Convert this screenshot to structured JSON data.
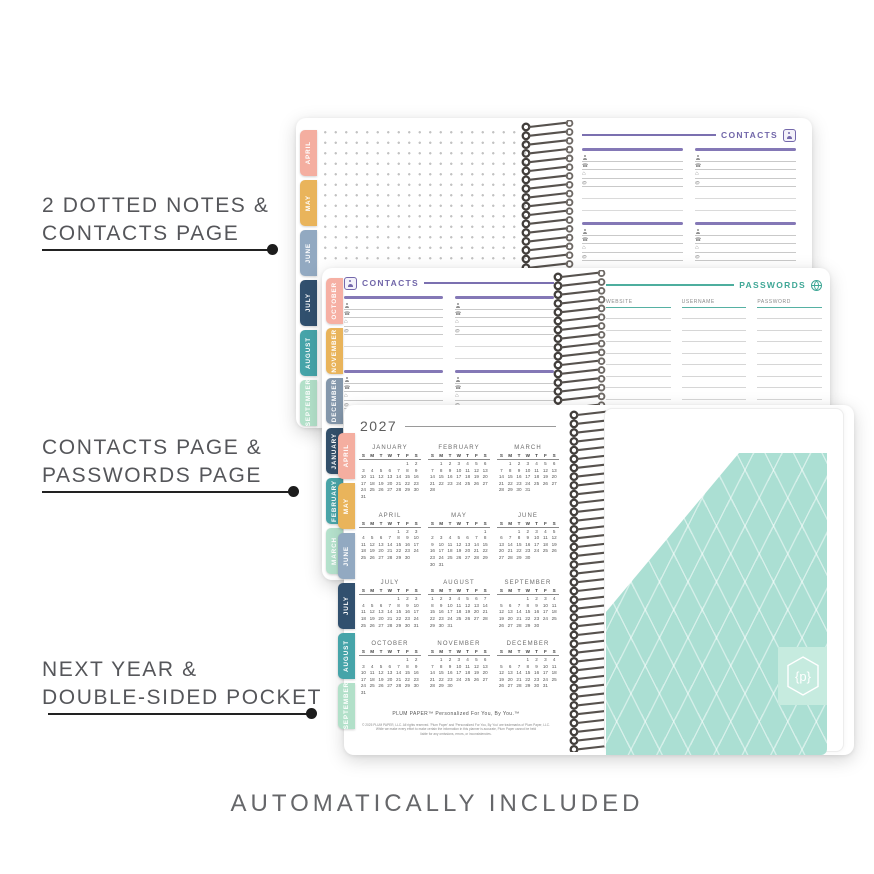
{
  "labels": {
    "callout1": {
      "line1": "2 DOTTED NOTES &",
      "line2": "CONTACTS PAGE"
    },
    "callout2": {
      "line1": "CONTACTS PAGE &",
      "line2": "PASSWORDS PAGE"
    },
    "callout3": {
      "line1": "NEXT YEAR &",
      "line2": "DOUBLE-SIDED POCKET"
    },
    "bottom_caption": "AUTOMATICALLY INCLUDED"
  },
  "colors": {
    "accent_purple": "#7166A9",
    "accent_teal": "#3FA796",
    "pocket_mint": "#ABDFD3",
    "logo_square_mint": "#C6EBDF",
    "coil_gray": "#4e4a47"
  },
  "icons": {
    "contact_fields": [
      "person",
      "phone",
      "home",
      "email"
    ],
    "contacts_header": "address-book-icon",
    "passwords_header": "globe-icon"
  },
  "spreads": {
    "top": {
      "tabs": [
        {
          "label": "APRIL",
          "color": "#F4AEA0"
        },
        {
          "label": "MAY",
          "color": "#E9B45B"
        },
        {
          "label": "JUNE",
          "color": "#92A9C1"
        },
        {
          "label": "JULY",
          "color": "#31506E"
        },
        {
          "label": "AUGUST",
          "color": "#46A4A9"
        },
        {
          "label": "SEPTEMBER",
          "color": "#B2E0C9"
        }
      ],
      "contacts": {
        "title": "CONTACTS",
        "block_count": 4,
        "field_rows": [
          "person",
          "phone",
          "home",
          "email"
        ],
        "plain_lines": 2
      }
    },
    "middle": {
      "tabs": [
        {
          "label": "OCTOBER",
          "color": "#F6B0A4"
        },
        {
          "label": "NOVEMBER",
          "color": "#E9B45B"
        },
        {
          "label": "DECEMBER",
          "color": "#8497AB"
        },
        {
          "label": "JANUARY",
          "color": "#33506B"
        },
        {
          "label": "FEBRUARY",
          "color": "#4AA5A8"
        },
        {
          "label": "MARCH",
          "color": "#B5E2CD"
        }
      ],
      "contacts": {
        "title": "CONTACTS",
        "block_count": 4,
        "field_rows": [
          "person",
          "phone",
          "home",
          "email"
        ],
        "plain_lines": 2
      },
      "passwords": {
        "title": "PASSWORDS",
        "columns": [
          "WEBSITE",
          "USERNAME",
          "PASSWORD"
        ],
        "line_count": 11
      }
    },
    "bottom": {
      "tabs": [
        {
          "label": "APRIL",
          "color": "#F4AEA0"
        },
        {
          "label": "MAY",
          "color": "#E9B45B"
        },
        {
          "label": "JUNE",
          "color": "#92A9C1"
        },
        {
          "label": "JULY",
          "color": "#31506E"
        },
        {
          "label": "AUGUST",
          "color": "#46A4A9"
        },
        {
          "label": "SEPTEMBER",
          "color": "#B2E0C9"
        }
      ],
      "year_page": {
        "year": "2027",
        "weekday_header": [
          "S",
          "M",
          "T",
          "W",
          "T",
          "F",
          "S"
        ],
        "months": [
          {
            "name": "JANUARY",
            "weeks": [
              [
                "",
                "",
                "",
                "",
                "",
                "1",
                "2"
              ],
              [
                "3",
                "4",
                "5",
                "6",
                "7",
                "8",
                "9"
              ],
              [
                "10",
                "11",
                "12",
                "13",
                "14",
                "15",
                "16"
              ],
              [
                "17",
                "18",
                "19",
                "20",
                "21",
                "22",
                "23"
              ],
              [
                "24",
                "25",
                "26",
                "27",
                "28",
                "29",
                "30"
              ],
              [
                "31",
                "",
                "",
                "",
                "",
                "",
                ""
              ]
            ]
          },
          {
            "name": "FEBRUARY",
            "weeks": [
              [
                "",
                "1",
                "2",
                "3",
                "4",
                "5",
                "6"
              ],
              [
                "7",
                "8",
                "9",
                "10",
                "11",
                "12",
                "13"
              ],
              [
                "14",
                "15",
                "16",
                "17",
                "18",
                "19",
                "20"
              ],
              [
                "21",
                "22",
                "23",
                "24",
                "25",
                "26",
                "27"
              ],
              [
                "28",
                "",
                "",
                "",
                "",
                "",
                ""
              ]
            ]
          },
          {
            "name": "MARCH",
            "weeks": [
              [
                "",
                "1",
                "2",
                "3",
                "4",
                "5",
                "6"
              ],
              [
                "7",
                "8",
                "9",
                "10",
                "11",
                "12",
                "13"
              ],
              [
                "14",
                "15",
                "16",
                "17",
                "18",
                "19",
                "20"
              ],
              [
                "21",
                "22",
                "23",
                "24",
                "25",
                "26",
                "27"
              ],
              [
                "28",
                "29",
                "30",
                "31",
                "",
                "",
                ""
              ]
            ]
          },
          {
            "name": "APRIL",
            "weeks": [
              [
                "",
                "",
                "",
                "",
                "1",
                "2",
                "3"
              ],
              [
                "4",
                "5",
                "6",
                "7",
                "8",
                "9",
                "10"
              ],
              [
                "11",
                "12",
                "13",
                "14",
                "15",
                "16",
                "17"
              ],
              [
                "18",
                "19",
                "20",
                "21",
                "22",
                "23",
                "24"
              ],
              [
                "25",
                "26",
                "27",
                "28",
                "29",
                "30",
                ""
              ]
            ]
          },
          {
            "name": "MAY",
            "weeks": [
              [
                "",
                "",
                "",
                "",
                "",
                "",
                "1"
              ],
              [
                "2",
                "3",
                "4",
                "5",
                "6",
                "7",
                "8"
              ],
              [
                "9",
                "10",
                "11",
                "12",
                "13",
                "14",
                "15"
              ],
              [
                "16",
                "17",
                "18",
                "19",
                "20",
                "21",
                "22"
              ],
              [
                "23",
                "24",
                "25",
                "26",
                "27",
                "28",
                "29"
              ],
              [
                "30",
                "31",
                "",
                "",
                "",
                "",
                ""
              ]
            ]
          },
          {
            "name": "JUNE",
            "weeks": [
              [
                "",
                "",
                "1",
                "2",
                "3",
                "4",
                "5"
              ],
              [
                "6",
                "7",
                "8",
                "9",
                "10",
                "11",
                "12"
              ],
              [
                "13",
                "14",
                "15",
                "16",
                "17",
                "18",
                "19"
              ],
              [
                "20",
                "21",
                "22",
                "23",
                "24",
                "25",
                "26"
              ],
              [
                "27",
                "28",
                "29",
                "30",
                "",
                "",
                ""
              ]
            ]
          },
          {
            "name": "JULY",
            "weeks": [
              [
                "",
                "",
                "",
                "",
                "1",
                "2",
                "3"
              ],
              [
                "4",
                "5",
                "6",
                "7",
                "8",
                "9",
                "10"
              ],
              [
                "11",
                "12",
                "13",
                "14",
                "15",
                "16",
                "17"
              ],
              [
                "18",
                "19",
                "20",
                "21",
                "22",
                "23",
                "24"
              ],
              [
                "25",
                "26",
                "27",
                "28",
                "29",
                "30",
                "31"
              ]
            ]
          },
          {
            "name": "AUGUST",
            "weeks": [
              [
                "1",
                "2",
                "3",
                "4",
                "5",
                "6",
                "7"
              ],
              [
                "8",
                "9",
                "10",
                "11",
                "12",
                "13",
                "14"
              ],
              [
                "15",
                "16",
                "17",
                "18",
                "19",
                "20",
                "21"
              ],
              [
                "22",
                "23",
                "24",
                "25",
                "26",
                "27",
                "28"
              ],
              [
                "29",
                "30",
                "31",
                "",
                "",
                "",
                ""
              ]
            ]
          },
          {
            "name": "SEPTEMBER",
            "weeks": [
              [
                "",
                "",
                "",
                "1",
                "2",
                "3",
                "4"
              ],
              [
                "5",
                "6",
                "7",
                "8",
                "9",
                "10",
                "11"
              ],
              [
                "12",
                "13",
                "14",
                "15",
                "16",
                "17",
                "18"
              ],
              [
                "19",
                "20",
                "21",
                "22",
                "23",
                "24",
                "25"
              ],
              [
                "26",
                "27",
                "28",
                "29",
                "30",
                "",
                ""
              ]
            ]
          },
          {
            "name": "OCTOBER",
            "weeks": [
              [
                "",
                "",
                "",
                "",
                "",
                "1",
                "2"
              ],
              [
                "3",
                "4",
                "5",
                "6",
                "7",
                "8",
                "9"
              ],
              [
                "10",
                "11",
                "12",
                "13",
                "14",
                "15",
                "16"
              ],
              [
                "17",
                "18",
                "19",
                "20",
                "21",
                "22",
                "23"
              ],
              [
                "24",
                "25",
                "26",
                "27",
                "28",
                "29",
                "30"
              ],
              [
                "31",
                "",
                "",
                "",
                "",
                "",
                ""
              ]
            ]
          },
          {
            "name": "NOVEMBER",
            "weeks": [
              [
                "",
                "1",
                "2",
                "3",
                "4",
                "5",
                "6"
              ],
              [
                "7",
                "8",
                "9",
                "10",
                "11",
                "12",
                "13"
              ],
              [
                "14",
                "15",
                "16",
                "17",
                "18",
                "19",
                "20"
              ],
              [
                "21",
                "22",
                "23",
                "24",
                "25",
                "26",
                "27"
              ],
              [
                "28",
                "29",
                "30",
                "",
                "",
                "",
                ""
              ]
            ]
          },
          {
            "name": "DECEMBER",
            "weeks": [
              [
                "",
                "",
                "",
                "1",
                "2",
                "3",
                "4"
              ],
              [
                "5",
                "6",
                "7",
                "8",
                "9",
                "10",
                "11"
              ],
              [
                "12",
                "13",
                "14",
                "15",
                "16",
                "17",
                "18"
              ],
              [
                "19",
                "20",
                "21",
                "22",
                "23",
                "24",
                "25"
              ],
              [
                "26",
                "27",
                "28",
                "29",
                "30",
                "31",
                ""
              ]
            ]
          }
        ],
        "brand_line": "PLUM PAPER™    Personalized For You, By You.™",
        "legal_lines": [
          "© 2025 PLUM PAPER, LLC. All rights reserved. 'Plum Paper' and 'Personalized For You, By You' are trademarks of Plum Paper, LLC.",
          "While we make every effort to make certain the information in this planner is accurate, Plum Paper cannot be held",
          "liable for any omissions, errors, or inconsistencies."
        ]
      },
      "pocket": {
        "logo_text": "{p}"
      }
    }
  }
}
